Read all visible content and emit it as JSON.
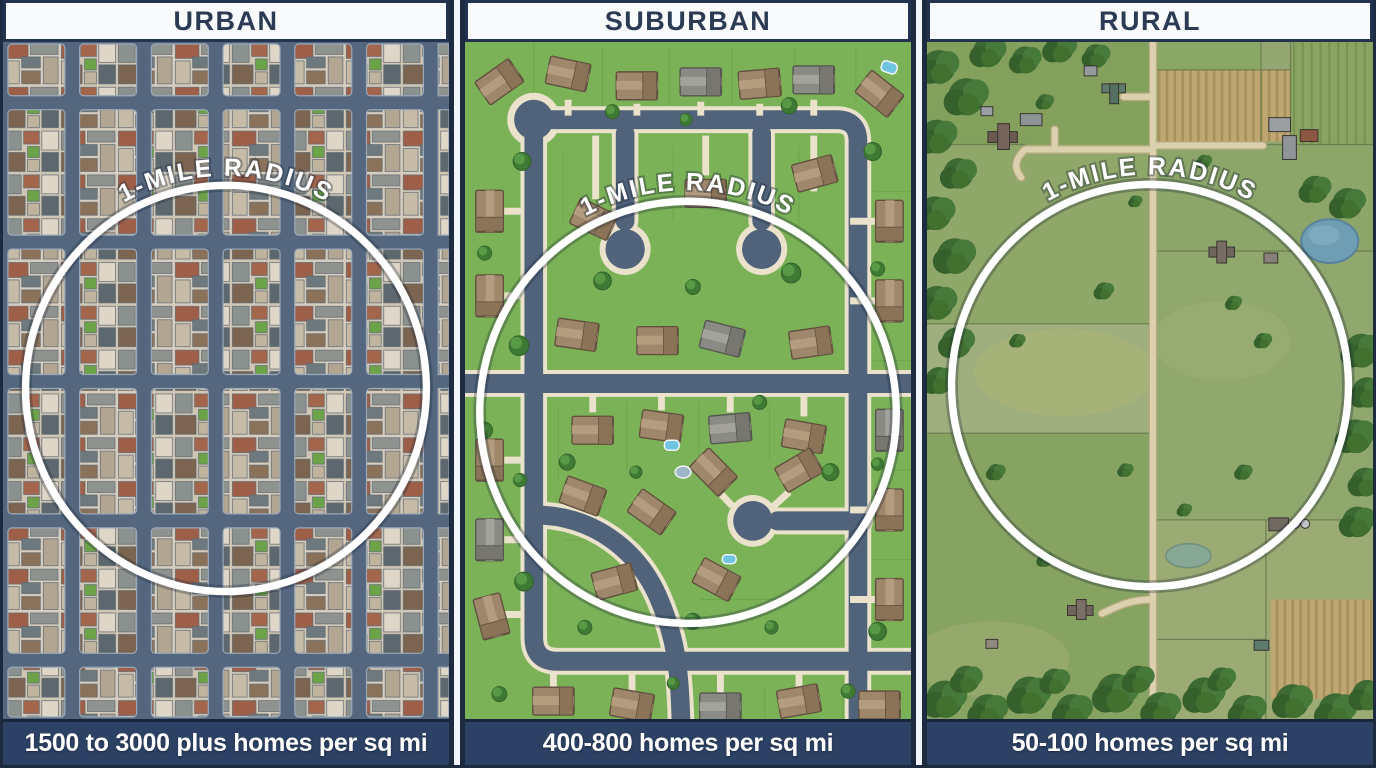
{
  "figure": {
    "type": "housing-density-comparison",
    "description": "Three overhead map illustrations comparing homes per square mile within a 1-mile radius"
  },
  "panels": [
    {
      "id": "urban",
      "title": "URBAN",
      "circle_label": "1-MILE RADIUS",
      "caption": "1500 to 3000 plus homes per sq mi"
    },
    {
      "id": "suburban",
      "title": "SUBURBAN",
      "circle_label": "1-MILE RADIUS",
      "caption": "400-800 homes per sq mi"
    },
    {
      "id": "rural",
      "title": "RURAL",
      "circle_label": "1-MILE RADIUS",
      "caption": "50-100 homes per sq mi"
    }
  ],
  "colors": {
    "header_bg": "#f8fafb",
    "header_text": "#2b3b54",
    "caption_bg": "#2c4164",
    "caption_text": "#ffffff",
    "frame_divider": "#1c2b3f",
    "radius_ring": "#ffffff",
    "urban_street": "#55677e",
    "urban_block": "#d6cdbc",
    "urban_brick": "#9e5f49",
    "suburban_grass": "#7cb257",
    "suburban_street": "#51637a",
    "suburban_sidewalk": "#eae2cb",
    "rural_pasture": "#94a671",
    "rural_plowed_field": "#bfa771",
    "forest": "#3d6a33",
    "pond": "#6f9db4"
  }
}
